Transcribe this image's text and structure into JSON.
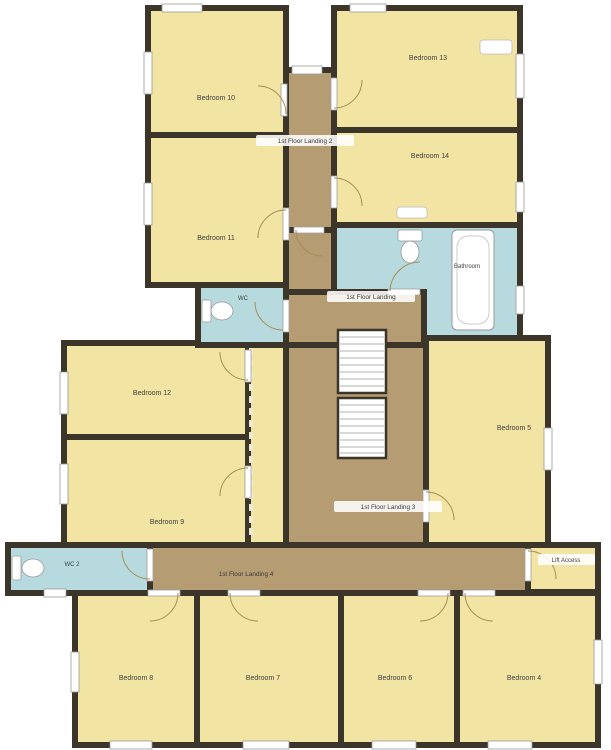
{
  "floor_plan": {
    "labels": {
      "bedroom_10": "Bedroom 10",
      "bedroom_11": "Bedroom 11",
      "bedroom_12": "Bedroom 12",
      "bedroom_13": "Bedroom 13",
      "bedroom_14": "Bedroom 14",
      "bedroom_9": "Bedroom 9",
      "bedroom_8": "Bedroom 8",
      "bedroom_7": "Bedroom 7",
      "bedroom_6": "Bedroom 6",
      "bedroom_5": "Bedroom 5",
      "bedroom_4": "Bedroom 4",
      "bathroom": "Bathroom",
      "wc": "WC",
      "wc_2": "WC 2",
      "lift_access": "Lift Access",
      "landing_1": "1st Floor Landing",
      "landing_2": "1st Floor Landing 2",
      "landing_3": "1st Floor Landing 3",
      "landing_4": "1st Floor Landing 4"
    },
    "colors": {
      "wall": "#3b352a",
      "bedroom_fill": "#f2e4a3",
      "corridor_fill": "#b59c72",
      "wet_room_fill": "#b6dade",
      "fixture_fill": "#ffffff",
      "background": "#ffffff",
      "label_text": "#3f3f3f"
    }
  }
}
